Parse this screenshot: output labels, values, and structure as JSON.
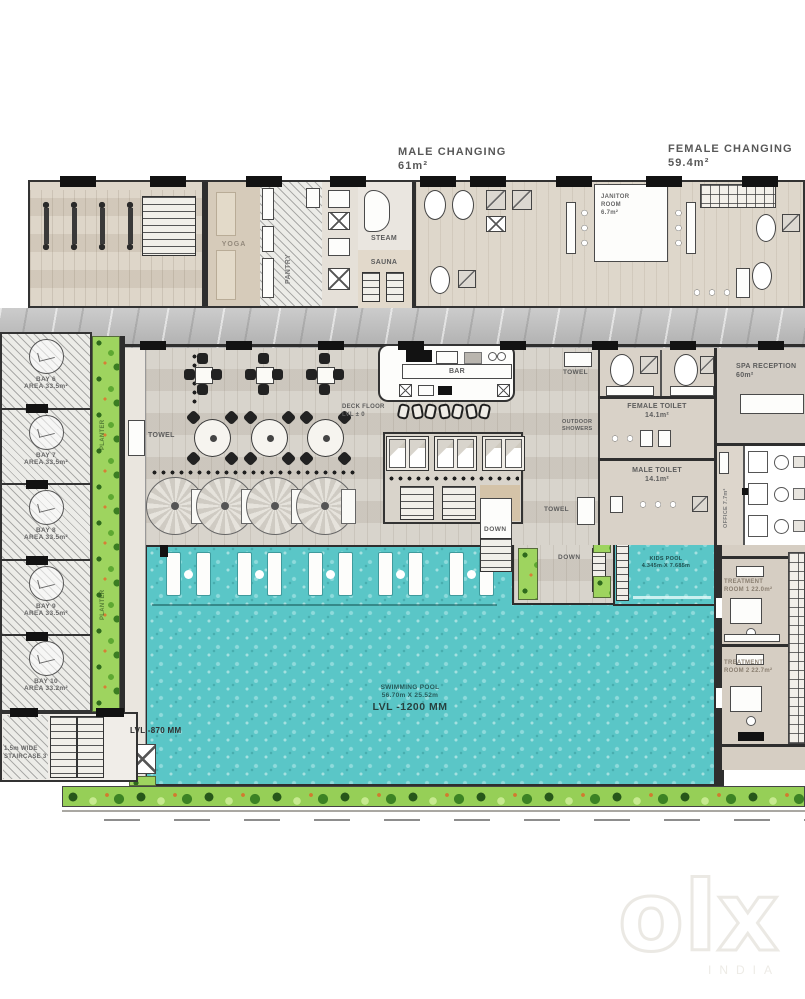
{
  "header": {
    "male_changing": "MALE CHANGING",
    "male_changing_area": "61m²",
    "female_changing": "FEMALE CHANGING",
    "female_changing_area": "59.4m²"
  },
  "rooms": {
    "yoga": "YOGA",
    "pantry": "PANTRY",
    "steam": "STEAM",
    "sauna": "SAUNA",
    "janitor_1": "JANITOR",
    "janitor_2": "ROOM",
    "janitor_area": "6.7m²",
    "bar": "BAR",
    "towel": "TOWEL",
    "deck_floor_1": "DECK FLOOR",
    "deck_floor_2": "LVL ± 0",
    "outdoor_1": "OUTDOOR",
    "outdoor_2": "SHOWERS",
    "spa_reception": "SPA RECEPTION",
    "spa_reception_area": "60m²",
    "female_toilet": "FEMALE TOILET",
    "female_toilet_area": "14.1m²",
    "male_toilet": "MALE TOILET",
    "male_toilet_area": "14.1m²",
    "office": "OFFICE 7.7m²",
    "treatment_1a": "TREATMENT",
    "treatment_1b": "ROOM 1  22.0m²",
    "treatment_2a": "TREATMENT",
    "treatment_2b": "ROOM 2  22.7m²",
    "down": "DOWN",
    "planter": "PLANTER"
  },
  "pool": {
    "name": "SWIMMING POOL",
    "dims": "56.70m X 25.52m",
    "level": "LVL -1200 MM",
    "deck_level": "LVL -870 MM",
    "kids_name": "KIDS POOL",
    "kids_dims": "4.345m X 7.685m"
  },
  "stairs": {
    "line1": "1.5m WIDE",
    "line2": "STAIRCASE 3"
  },
  "bays": [
    {
      "name": "BAY 6",
      "area": "AREA 33.5m²"
    },
    {
      "name": "BAY 7",
      "area": "AREA 33.5m²"
    },
    {
      "name": "BAY 8",
      "area": "AREA 33.5m²"
    },
    {
      "name": "BAY 9",
      "area": "AREA 33.5m²"
    },
    {
      "name": "BAY 10",
      "area": "AREA 33.2m²"
    }
  ],
  "watermark": {
    "logo": "olx",
    "country": "INDIA"
  },
  "colors": {
    "pool_water": "#5ac6c7",
    "planter_green": "#8ccc54",
    "wall": "#2e2e2e"
  }
}
